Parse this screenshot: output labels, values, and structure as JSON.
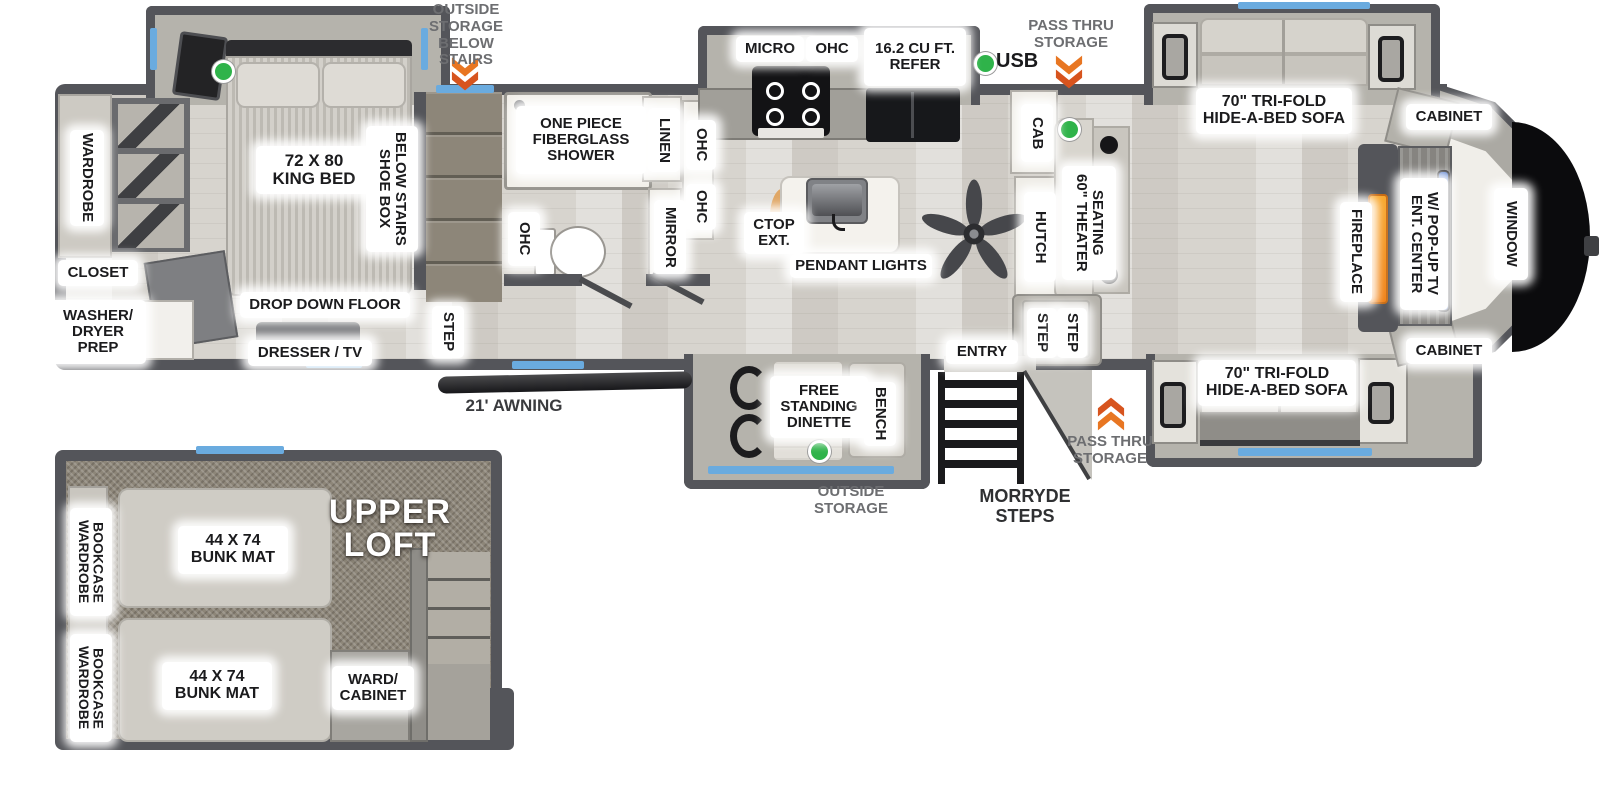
{
  "title": "Fifth wheel RV floor plan",
  "colors": {
    "wall": "#54555a",
    "floor": "#d7d4ce",
    "carpet": "#8d8679",
    "window_accent": "#6aabdf",
    "arrow_orange": "#e87622",
    "arrow_orange_dark": "#d7541e",
    "indicator_green": "#2fb34a",
    "fireplace_orange": "#f6921e",
    "tv_blue": "#3a68c6",
    "label_bg": "#ffffff",
    "label_text": "#1b1b1d",
    "note_gray": "#6d6e71"
  },
  "exterior": {
    "outside_storage_below_stairs": "OUTSIDE\nSTORAGE\nBELOW\nSTAIRS",
    "usb": "USB",
    "pass_thru_storage_top": "PASS THRU\nSTORAGE",
    "awning": "21' AWNING",
    "outside_storage_bottom": "OUTSIDE\nSTORAGE",
    "morryde_steps": "MORRYDE\nSTEPS",
    "pass_thru_storage_bottom": "PASS THRU\nSTORAGE"
  },
  "bedroom": {
    "king_bed": "72 X 80\nKING BED",
    "shoe_box": "SHOE BOX\nBELOW STAIRS",
    "wardrobe": "WARDROBE",
    "closet": "CLOSET",
    "washer_dryer_prep": "WASHER/\nDRYER\nPREP",
    "drop_down_floor": "DROP DOWN FLOOR",
    "dresser_tv": "DRESSER / TV",
    "step": "STEP"
  },
  "bathroom": {
    "shower": "ONE PIECE\nFIBERGLASS\nSHOWER",
    "linen": "LINEN",
    "ohc_upper": "OHC",
    "ohc_lower": "OHC",
    "ohc_left": "OHC",
    "mirror": "MIRROR"
  },
  "kitchen": {
    "micro": "MICRO",
    "ohc": "OHC",
    "refer": "16.2 CU FT.\nREFER",
    "ctop_ext": "CTOP\nEXT.",
    "pendant_lights": "PENDANT LIGHTS",
    "cab": "CAB",
    "hutch": "HUTCH"
  },
  "living": {
    "sofa_top": "70\" TRI-FOLD\nHIDE-A-BED SOFA",
    "sofa_bottom": "70\" TRI-FOLD\nHIDE-A-BED SOFA",
    "cabinet_top": "CABINET",
    "cabinet_bottom": "CABINET",
    "theater_seating": "60\" THEATER\nSEATING",
    "fireplace": "FIREPLACE",
    "ent_center": "ENT. CENTER\nW/ POP-UP TV",
    "window": "WINDOW",
    "step_1": "STEP",
    "step_2": "STEP",
    "entry": "ENTRY"
  },
  "dinette": {
    "free_standing_dinette": "FREE\nSTANDING\nDINETTE",
    "bench": "BENCH"
  },
  "loft": {
    "title": "UPPER\nLOFT",
    "bunk_1": "44 X 74\nBUNK MAT",
    "bunk_2": "44 X 74\nBUNK MAT",
    "wardrobe_bookcase_1": "WARDROBE\nBOOKCASE",
    "wardrobe_bookcase_2": "WARDROBE\nBOOKCASE",
    "ward_cabinet": "WARD/\nCABINET"
  }
}
